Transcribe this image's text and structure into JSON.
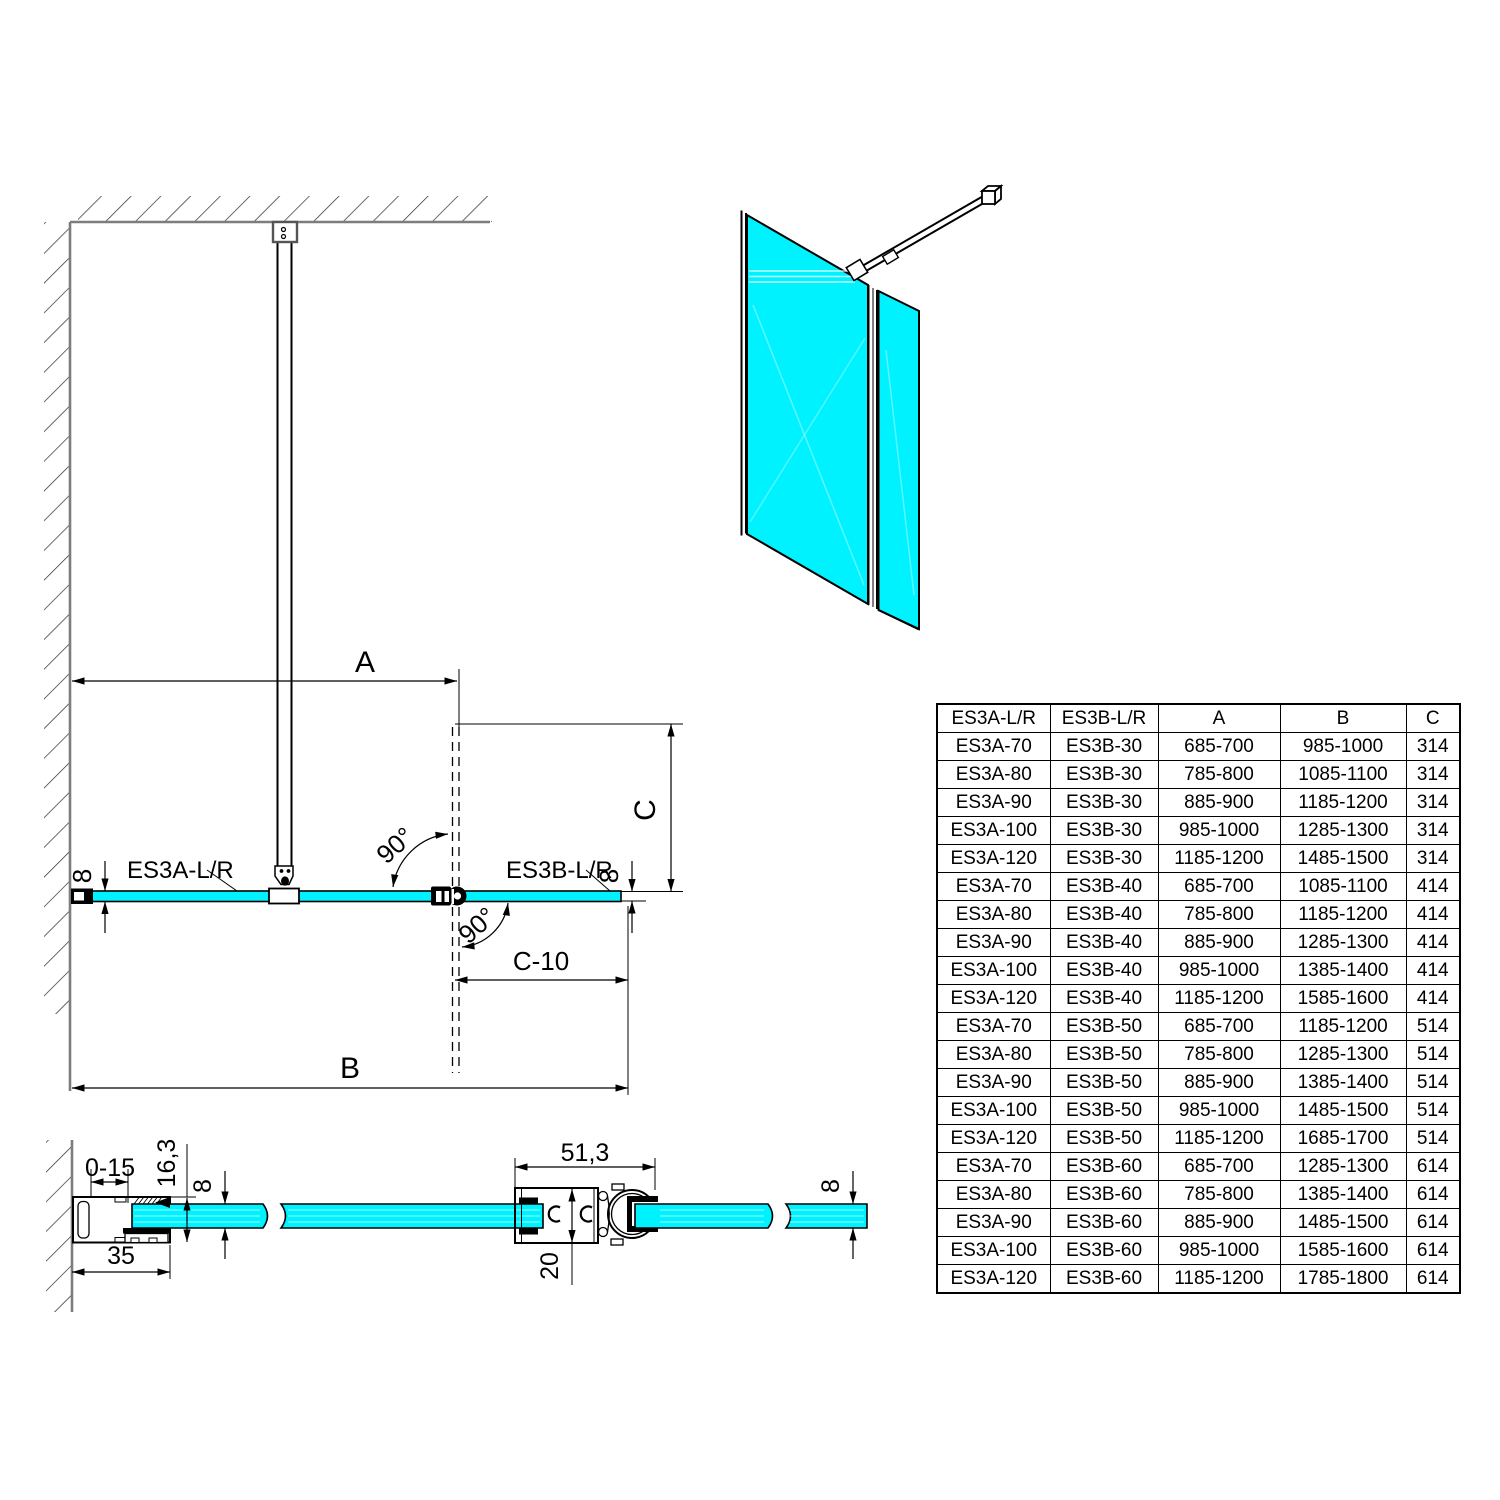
{
  "colors": {
    "glass": "#00F2FF",
    "outline": "#000000",
    "wall": "#7d7d7d"
  },
  "plan": {
    "dim_a": "A",
    "dim_b": "B",
    "dim_c": "C",
    "dim_c_minus_10": "C-10",
    "angle_label": "90°",
    "glass_thickness": "8",
    "panel_a_label": "ES3A-L/R",
    "panel_b_label": "ES3B-L/R"
  },
  "wall_profile_section": {
    "adjust_range": "0-15",
    "profile_depth": "16,3",
    "glass_thickness": "8",
    "profile_width": "35"
  },
  "hinge_section": {
    "profile_width": "51,3",
    "profile_height": "20",
    "glass_thickness": "8"
  },
  "table": {
    "headers": [
      "ES3A-L/R",
      "ES3B-L/R",
      "A",
      "B",
      "C"
    ],
    "rows": [
      [
        "ES3A-70",
        "ES3B-30",
        "685-700",
        "985-1000",
        "314"
      ],
      [
        "ES3A-80",
        "ES3B-30",
        "785-800",
        "1085-1100",
        "314"
      ],
      [
        "ES3A-90",
        "ES3B-30",
        "885-900",
        "1185-1200",
        "314"
      ],
      [
        "ES3A-100",
        "ES3B-30",
        "985-1000",
        "1285-1300",
        "314"
      ],
      [
        "ES3A-120",
        "ES3B-30",
        "1185-1200",
        "1485-1500",
        "314"
      ],
      [
        "ES3A-70",
        "ES3B-40",
        "685-700",
        "1085-1100",
        "414"
      ],
      [
        "ES3A-80",
        "ES3B-40",
        "785-800",
        "1185-1200",
        "414"
      ],
      [
        "ES3A-90",
        "ES3B-40",
        "885-900",
        "1285-1300",
        "414"
      ],
      [
        "ES3A-100",
        "ES3B-40",
        "985-1000",
        "1385-1400",
        "414"
      ],
      [
        "ES3A-120",
        "ES3B-40",
        "1185-1200",
        "1585-1600",
        "414"
      ],
      [
        "ES3A-70",
        "ES3B-50",
        "685-700",
        "1185-1200",
        "514"
      ],
      [
        "ES3A-80",
        "ES3B-50",
        "785-800",
        "1285-1300",
        "514"
      ],
      [
        "ES3A-90",
        "ES3B-50",
        "885-900",
        "1385-1400",
        "514"
      ],
      [
        "ES3A-100",
        "ES3B-50",
        "985-1000",
        "1485-1500",
        "514"
      ],
      [
        "ES3A-120",
        "ES3B-50",
        "1185-1200",
        "1685-1700",
        "514"
      ],
      [
        "ES3A-70",
        "ES3B-60",
        "685-700",
        "1285-1300",
        "614"
      ],
      [
        "ES3A-80",
        "ES3B-60",
        "785-800",
        "1385-1400",
        "614"
      ],
      [
        "ES3A-90",
        "ES3B-60",
        "885-900",
        "1485-1500",
        "614"
      ],
      [
        "ES3A-100",
        "ES3B-60",
        "985-1000",
        "1585-1600",
        "614"
      ],
      [
        "ES3A-120",
        "ES3B-60",
        "1185-1200",
        "1785-1800",
        "614"
      ]
    ]
  }
}
